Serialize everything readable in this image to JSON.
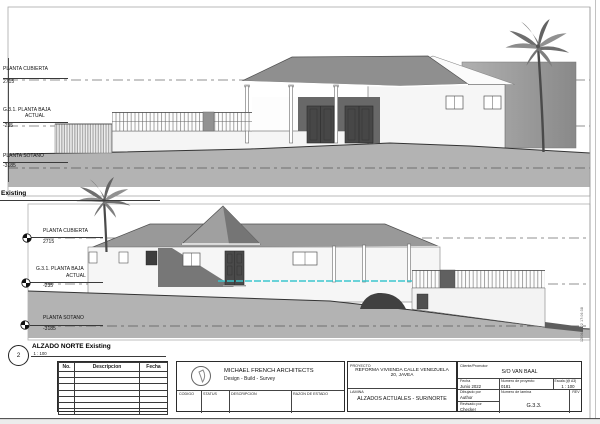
{
  "south_elevation": {
    "title_visible": "Existing",
    "levels": [
      {
        "name": "PLANTA CUBIERTA",
        "value": "2715"
      },
      {
        "name": "G.3.1. PLANTA BAJA",
        "name2": "ACTUAL",
        "value": "-235"
      },
      {
        "name": "PLANTA SOTANO",
        "value": "-3185"
      }
    ]
  },
  "north_elevation": {
    "number": "2",
    "title": "ALZADO NORTE Existing",
    "scale": "1 : 100",
    "levels": [
      {
        "name": "PLANTA CUBIERTA",
        "value": "2715"
      },
      {
        "name": "G.3.1. PLANTA BAJA",
        "name2": "ACTUAL",
        "value": "-235"
      },
      {
        "name": "PLANTA SOTANO",
        "value": "-3185"
      }
    ]
  },
  "title_block": {
    "revision_table": {
      "headers": [
        "No.",
        "Descripcion",
        "Fecha"
      ]
    },
    "architect": {
      "name": "MICHAEL FRENCH ARCHITECTS",
      "tagline": "Design - Build - Survey",
      "fields": [
        "CODIGO",
        "STATUS",
        "DESCRIPCION",
        "RAZON DE ESTADO"
      ]
    },
    "project": {
      "label": "PROYECTO",
      "name": "REFORMA VIVIENDA CALLE VENEZUELA 20, JAVEA",
      "sheet_label": "LAMINA",
      "sheet_name": "ALZADOS ACTUALES - SUR/NORTE"
    },
    "info": {
      "client_label": "Cliente/Promotor",
      "client": "S/O VAN BAAL",
      "date_label": "Fecha",
      "date": "Junio 2022",
      "project_no_label": "Numero de proyecto",
      "project_no": "0181",
      "scale_label": "Escala (@ A3)",
      "scale": "1 : 100",
      "drawn_label": "Dibujado por",
      "drawn": "Author",
      "sheet_no_label": "Numero de lamina",
      "sheet_no": "G.3.3.",
      "checked_label": "Revisado por",
      "checked": "Checker",
      "rev_label": "REV"
    },
    "timestamp": "12/06/2022 17:06:38"
  }
}
